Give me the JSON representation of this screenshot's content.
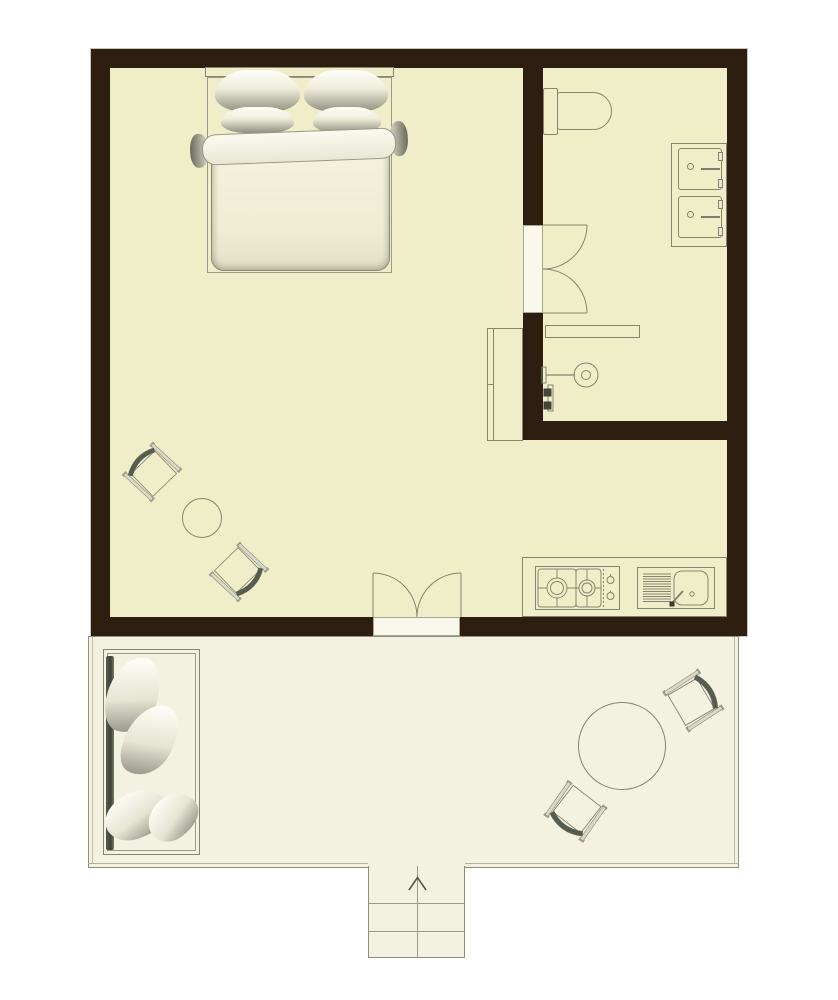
{
  "palette": {
    "background": "#ffffff",
    "wall": "#2d1e10",
    "room_floor": "#f0eec9",
    "terrace_floor": "#f3f1e0",
    "fixture_fill": "#faf8ec",
    "line": "#85856f",
    "dark_accent": "#575c51"
  },
  "plan": {
    "rooms": {
      "main_room": "studio room",
      "bathroom": "bathroom",
      "terrace": "terrace"
    },
    "furniture": {
      "bed": "double bed with pillows and duvet",
      "wardrobe": "wardrobe",
      "toilet": "toilet",
      "vanity": "vanity with two basins",
      "shelf": "bathroom shelf",
      "shower": "shower fixture",
      "bathroom_door": "double swing bathroom door",
      "entrance_door": "double entrance door",
      "kitchen_counter": "kitchenette counter",
      "stove": "two-burner gas hob",
      "kitchen_sink": "kitchen sink with drainboard",
      "side_table": "round side table",
      "room_chair": "folding chair",
      "terrace_table": "round terrace table",
      "terrace_chair": "folding terrace chair",
      "daybed": "terrace daybed with cushions",
      "stairs": "entrance steps",
      "entry_arrow": "entry direction arrow"
    }
  }
}
